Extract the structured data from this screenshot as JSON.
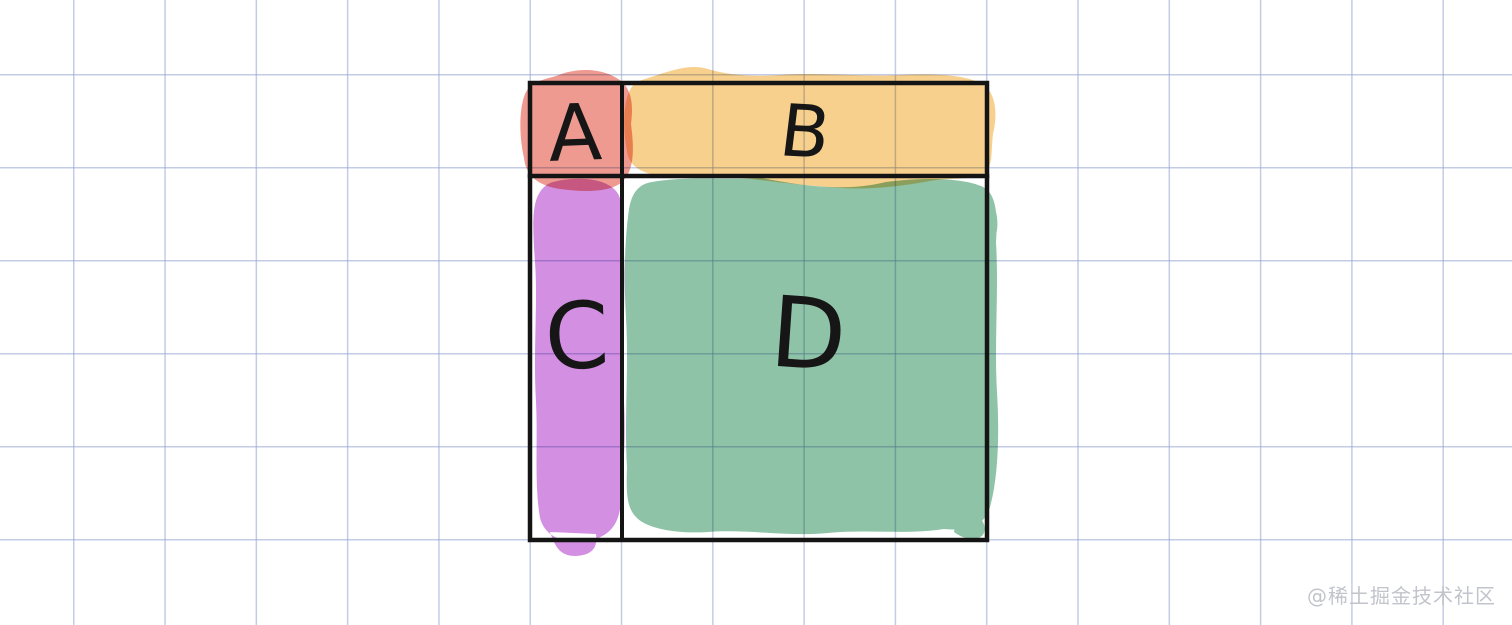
{
  "canvas": {
    "background_color": "#ffffff",
    "grid_line_color": "#94a3d0"
  },
  "diagram": {
    "description": "hand-drawn 2x2 quadrant table on squared paper",
    "border_color": "#141414",
    "cells": [
      {
        "id": "A",
        "label": "A",
        "highlight_color": "#ef9a90",
        "position": "top-left"
      },
      {
        "id": "B",
        "label": "B",
        "highlight_color": "#f8d08d",
        "position": "top-right"
      },
      {
        "id": "C",
        "label": "C",
        "highlight_color": "#d38fe2",
        "position": "bottom-left"
      },
      {
        "id": "D",
        "label": "D",
        "highlight_color": "#8fc3a7",
        "position": "bottom-right"
      }
    ]
  },
  "watermark": {
    "text": "@稀土掘金技术社区"
  }
}
